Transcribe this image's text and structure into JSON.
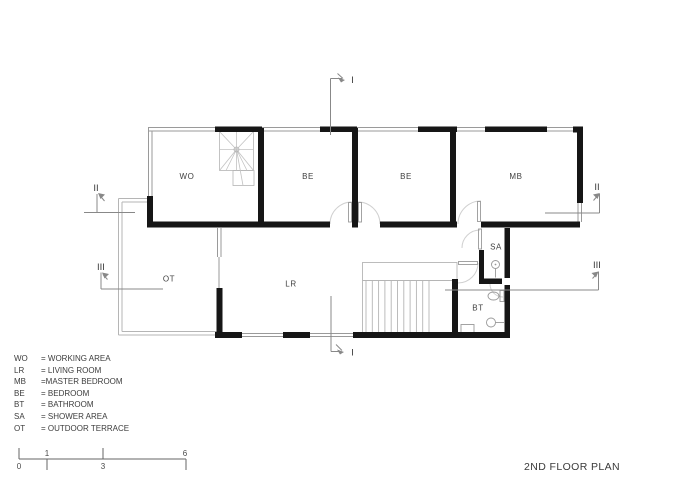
{
  "title": "2ND FLOOR PLAN",
  "rooms": {
    "wo": {
      "label": "WO"
    },
    "be1": {
      "label": "BE"
    },
    "be2": {
      "label": "BE"
    },
    "mb": {
      "label": "MB"
    },
    "sa": {
      "label": "SA"
    },
    "bt": {
      "label": "BT"
    },
    "lr": {
      "label": "LR"
    },
    "ot": {
      "label": "OT"
    }
  },
  "section_markers": {
    "i_top": "I",
    "i_bottom": "I",
    "ii_left": "II",
    "ii_right": "II",
    "iii_left": "III",
    "iii_right": "III"
  },
  "legend": {
    "items": [
      {
        "abbr": "WO",
        "desc": "= WORKING AREA"
      },
      {
        "abbr": "LR",
        "desc": "= LIVING ROOM"
      },
      {
        "abbr": "MB",
        "desc": "=MASTER BEDROOM"
      },
      {
        "abbr": "BE",
        "desc": "= BEDROOM"
      },
      {
        "abbr": "BT",
        "desc": "= BATHROOM"
      },
      {
        "abbr": "SA",
        "desc": "= SHOWER AREA"
      },
      {
        "abbr": "OT",
        "desc": "= OUTDOOR TERRACE"
      }
    ]
  },
  "scale_bar": {
    "ticks": [
      "0",
      "1",
      "3",
      "6"
    ]
  },
  "colors": {
    "wall": "#161616",
    "thin_line": "#9a9a9a",
    "light_line": "#c2c2c2",
    "marker_line": "#888888",
    "text": "#3c3c3c"
  }
}
